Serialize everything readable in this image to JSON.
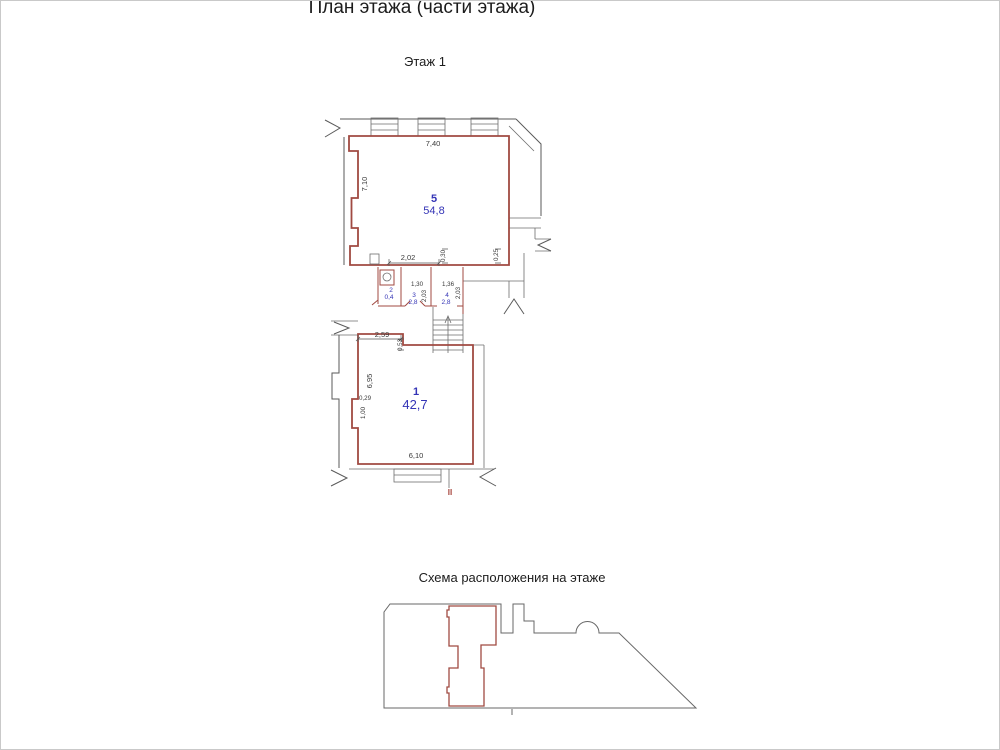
{
  "page": {
    "title": "План этажа (части этажа)",
    "floor_label": "Этаж 1",
    "scheme_caption": "Схема расположения на этаже",
    "section_mark": "II"
  },
  "colors": {
    "unit_outline": "#a04a42",
    "context_walls": "#5a5a5a",
    "room_labels": "#3434b6",
    "dimension_text": "#3a3a3a"
  },
  "rooms": [
    {
      "number": "5",
      "area": "54,8"
    },
    {
      "number": "2",
      "area": "0,4"
    },
    {
      "number": "3",
      "area": "2,8"
    },
    {
      "number": "4",
      "area": "2,8"
    },
    {
      "number": "1",
      "area": "42,7"
    }
  ],
  "dimensions": {
    "room5_top_width": "7,40",
    "room5_left_height": "7,10",
    "room5_bottom_left": "2,02",
    "room5_bottom_mid": "0,30",
    "room5_bottom_right": "0,25",
    "room3_width": "1,30",
    "room4_width": "1,36",
    "room3_depth": "2,03",
    "room4_depth": "2,03",
    "room1_top_left": "2,59",
    "room1_top_step": "0,53",
    "room1_left_height": "6,95",
    "room1_niche_width": "0,29",
    "room1_niche_height": "1,00",
    "room1_bottom_width": "6,10"
  }
}
